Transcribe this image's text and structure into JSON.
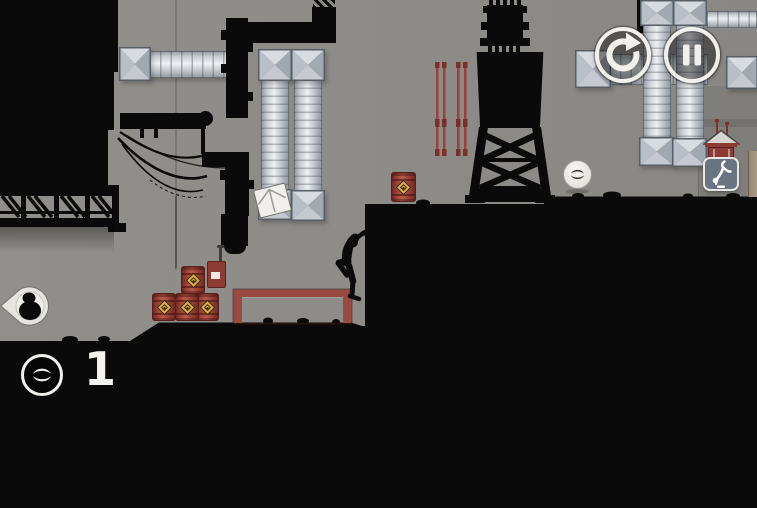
{
  "hud": {
    "restart_button": {
      "icon": "restart-arrow-icon"
    },
    "pause_button": {
      "icon": "pause-icon"
    },
    "bonus_counter": {
      "icon": "vector-logo-icon",
      "value": "1"
    },
    "pursuer_indicator": {
      "icon": "hunter-head-icon",
      "direction": "left"
    }
  },
  "level": {
    "collectible_coin": {
      "icon": "vector-coin-icon"
    },
    "trick_sign": {
      "icon": "parkour-trick-figure-icon"
    },
    "player_character": {
      "state": "silhouette climbing wall edge"
    },
    "props": [
      "air-ducts",
      "hanging-cables",
      "truss-catwalk",
      "water-tower",
      "chimney-pipe",
      "red-climbing-poles",
      "hazard-barrels",
      "warning-sign",
      "goal-frame",
      "white-crate",
      "rooftop-barrel",
      "shed-with-antennas"
    ]
  },
  "colors": {
    "background_concrete": "#8d8b88",
    "silhouette_black": "#0a0a0a",
    "barrel_red": "#a04338",
    "hazard_diamond_yellow": "#dfae3e",
    "frame_red": "#9a4a40",
    "ui_white": "#f1f0ec",
    "trick_sign_fill": "#6a7480"
  }
}
